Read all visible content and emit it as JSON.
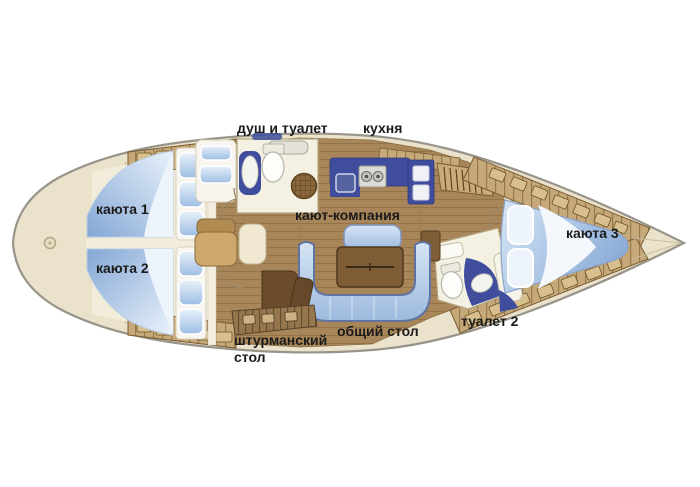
{
  "diagram": {
    "type": "yacht-interior-floor-plan",
    "labels": {
      "shower_toilet": "душ и туалет",
      "kitchen": "кухня",
      "cabin1": "каюта 1",
      "cabin2": "каюта 2",
      "saloon": "кают-компания",
      "cabin3": "каюта 3",
      "toilet2": "туалет 2",
      "common_table": "общий стол",
      "nav_table_line1": "штурманский",
      "nav_table_line2": "стол"
    },
    "palette": {
      "background": "#ffffff",
      "hull_deck": "#ebe2cb",
      "hull_outline": "#98948a",
      "wood_floor": "#a8865a",
      "dark_blue": "#3f4d9c",
      "light_blue": "#9dbde2",
      "light_blue_soft": "#d9e7f6",
      "room_cream": "#f5f1e2",
      "locker_tan": "#c6a978",
      "locker_line": "#6e5128",
      "table_brown": "#7d5c36",
      "chair_brown": "#6b4c2a",
      "label_text": "#1b1b1b"
    }
  }
}
